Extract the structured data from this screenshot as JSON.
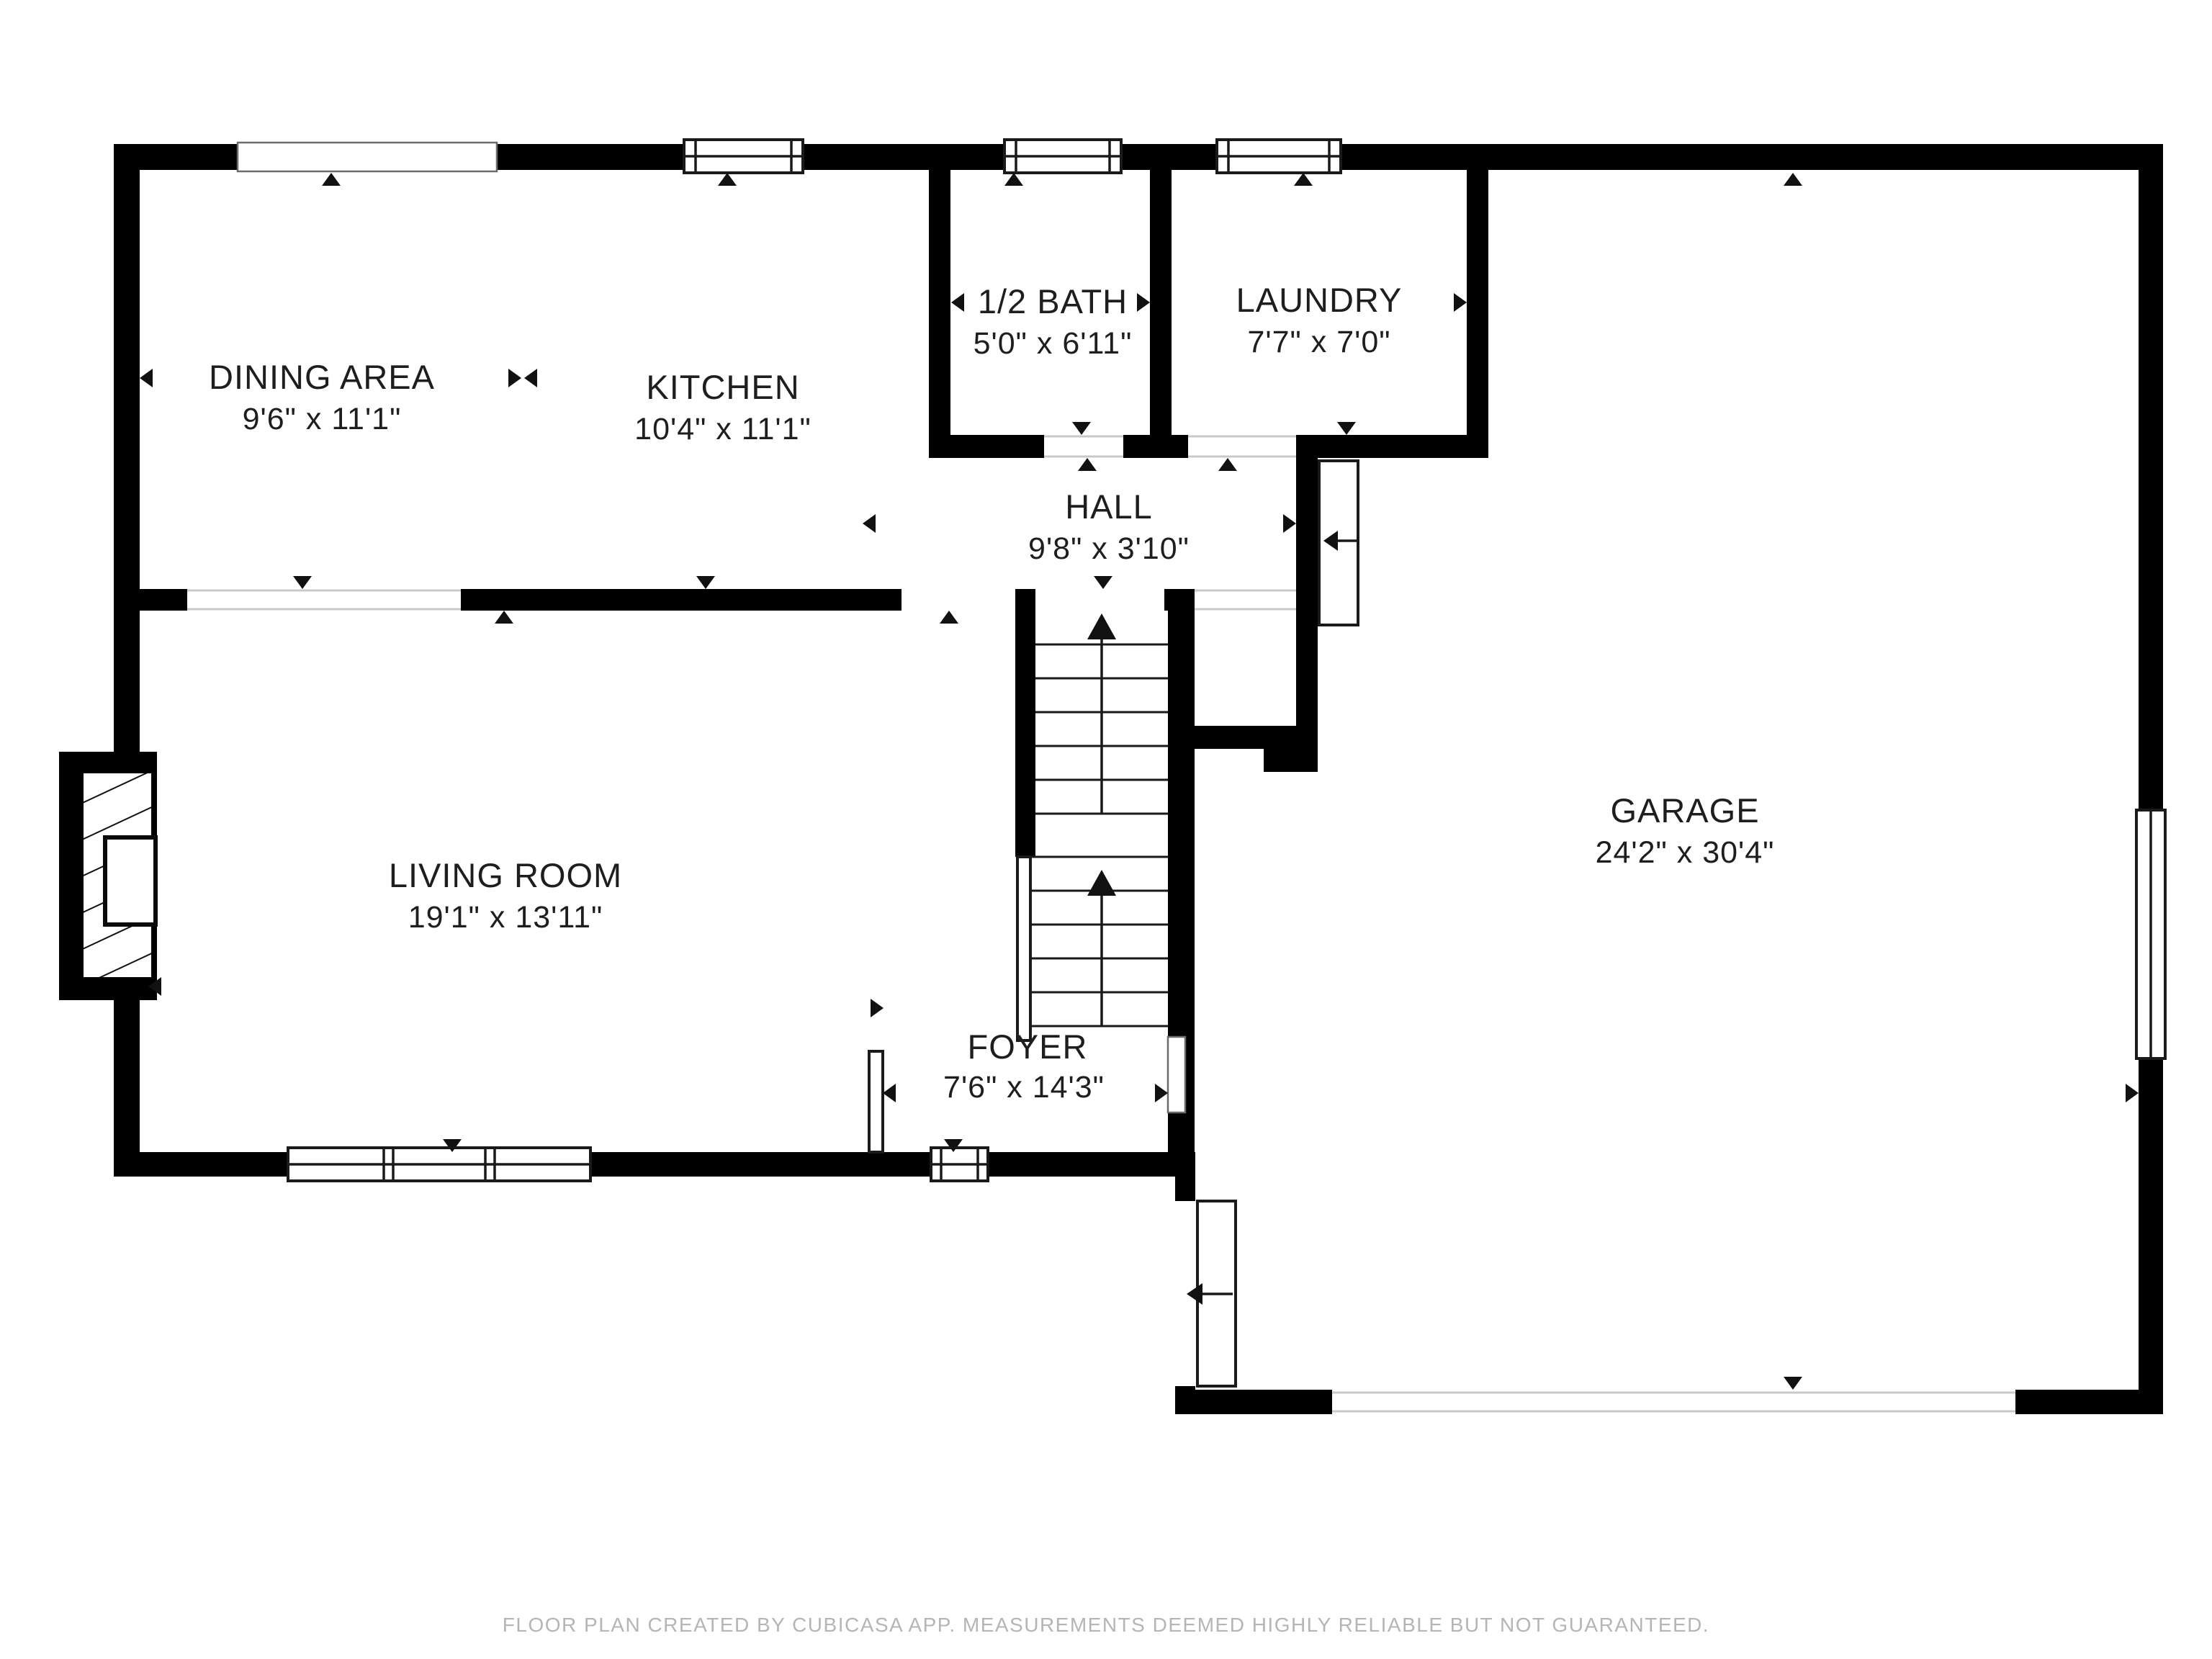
{
  "floor_plan": {
    "rooms": [
      {
        "id": "dining",
        "name": "DINING AREA",
        "dims": "9'6\" x 11'1\""
      },
      {
        "id": "kitchen",
        "name": "KITCHEN",
        "dims": "10'4\" x 11'1\""
      },
      {
        "id": "bath",
        "name": "1/2 BATH",
        "dims": "5'0\" x 6'11\""
      },
      {
        "id": "laundry",
        "name": "LAUNDRY",
        "dims": "7'7\" x 7'0\""
      },
      {
        "id": "hall",
        "name": "HALL",
        "dims": "9'8\" x 3'10\""
      },
      {
        "id": "living",
        "name": "LIVING ROOM",
        "dims": "19'1\" x 13'11\""
      },
      {
        "id": "foyer",
        "name": "FOYER",
        "dims": "7'6\" x 14'3\""
      },
      {
        "id": "garage",
        "name": "GARAGE",
        "dims": "24'2\" x 30'4\""
      }
    ],
    "footer": {
      "text": "FLOOR PLAN CREATED BY CUBICASA APP. MEASUREMENTS DEEMED HIGHLY RELIABLE BUT NOT GUARANTEED."
    },
    "colors": {
      "wall": "#000000",
      "background": "#ffffff",
      "label_text": "#1e1e1e",
      "footer_text": "#b5b5b5"
    }
  }
}
